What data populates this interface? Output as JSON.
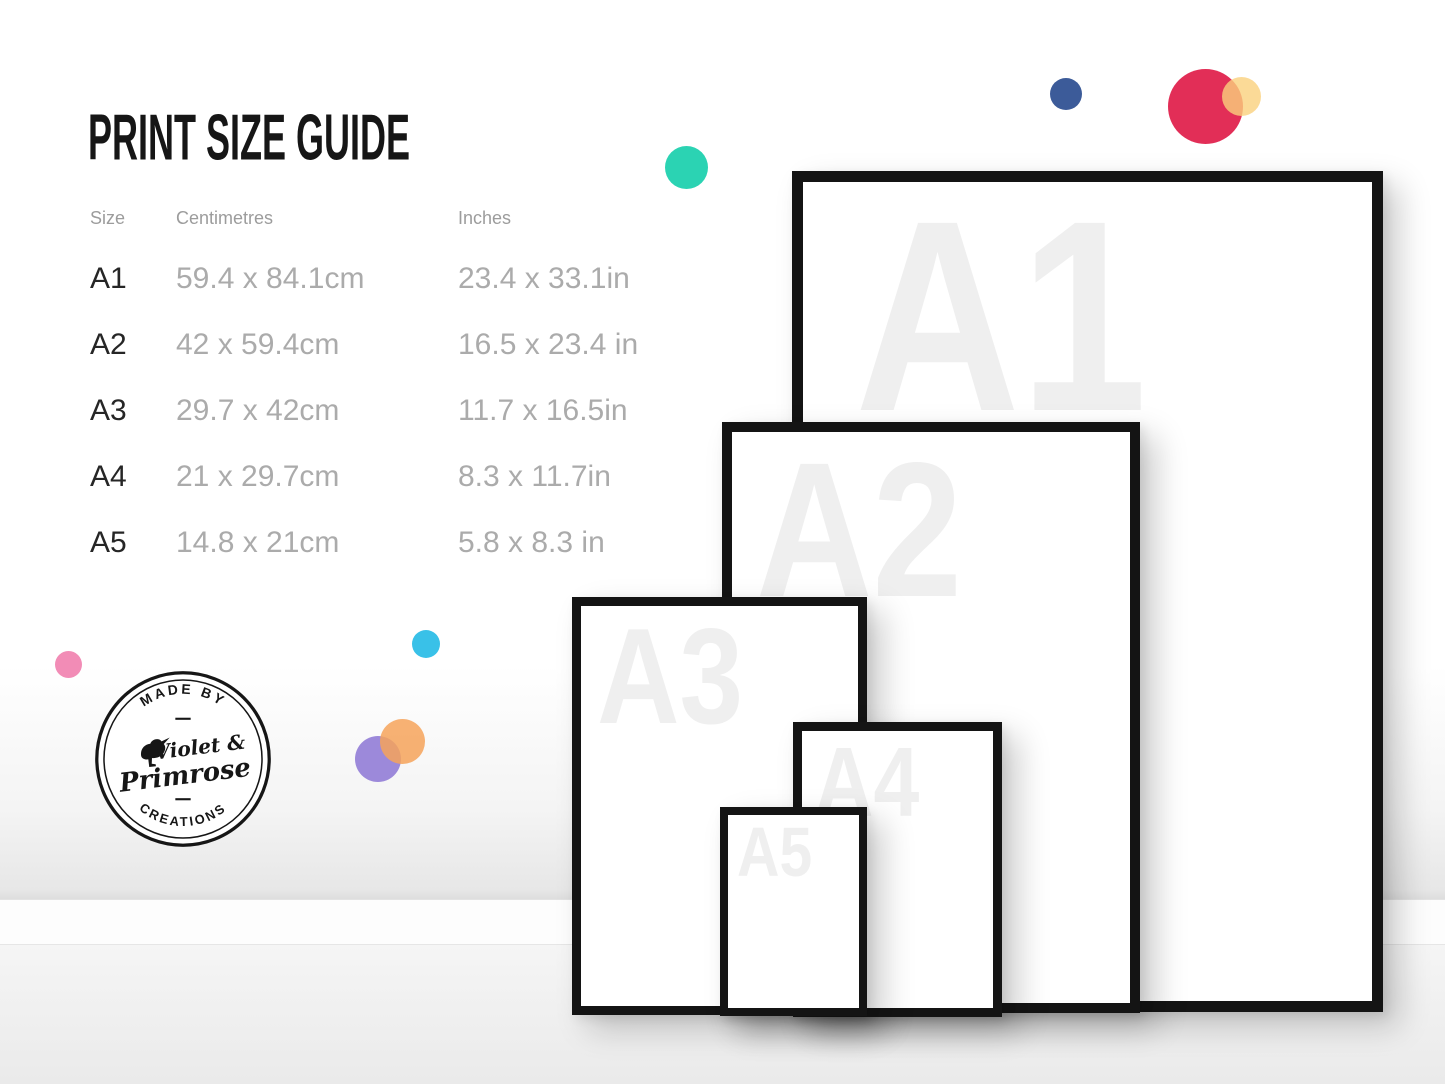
{
  "title": "PRINT SIZE GUIDE",
  "table": {
    "headers": {
      "size": "Size",
      "cm": "Centimetres",
      "inches": "Inches"
    },
    "rows": [
      {
        "size": "A1",
        "cm": "59.4 x 84.1cm",
        "inches": "23.4 x 33.1in"
      },
      {
        "size": "A2",
        "cm": "42 x 59.4cm",
        "inches": "16.5 x 23.4 in"
      },
      {
        "size": "A3",
        "cm": "29.7 x 42cm",
        "inches": "11.7 x 16.5in"
      },
      {
        "size": "A4",
        "cm": "21 x 29.7cm",
        "inches": "8.3 x 11.7in"
      },
      {
        "size": "A5",
        "cm": "14.8 x 21cm",
        "inches": "5.8 x 8.3 in"
      }
    ]
  },
  "frames": [
    {
      "label": "A1"
    },
    {
      "label": "A2"
    },
    {
      "label": "A3"
    },
    {
      "label": "A4"
    },
    {
      "label": "A5"
    }
  ],
  "logo": {
    "top_text": "MADE BY",
    "name_line1": "Violet &",
    "name_line2": "Primrose",
    "bottom_text": "CREATIONS"
  },
  "decoration_colors": {
    "navy": "#3c5b99",
    "crimson": "#e22e57",
    "yellow": "#fad17d",
    "teal": "#2bd3b3",
    "cyan": "#39c1e8",
    "pink": "#f28cb6",
    "purple": "#9c89da",
    "orange": "#f6a35a",
    "frame_border": "#141414",
    "frame_label": "#efefef",
    "text_dark": "#262626",
    "text_gray": "#ababab"
  }
}
